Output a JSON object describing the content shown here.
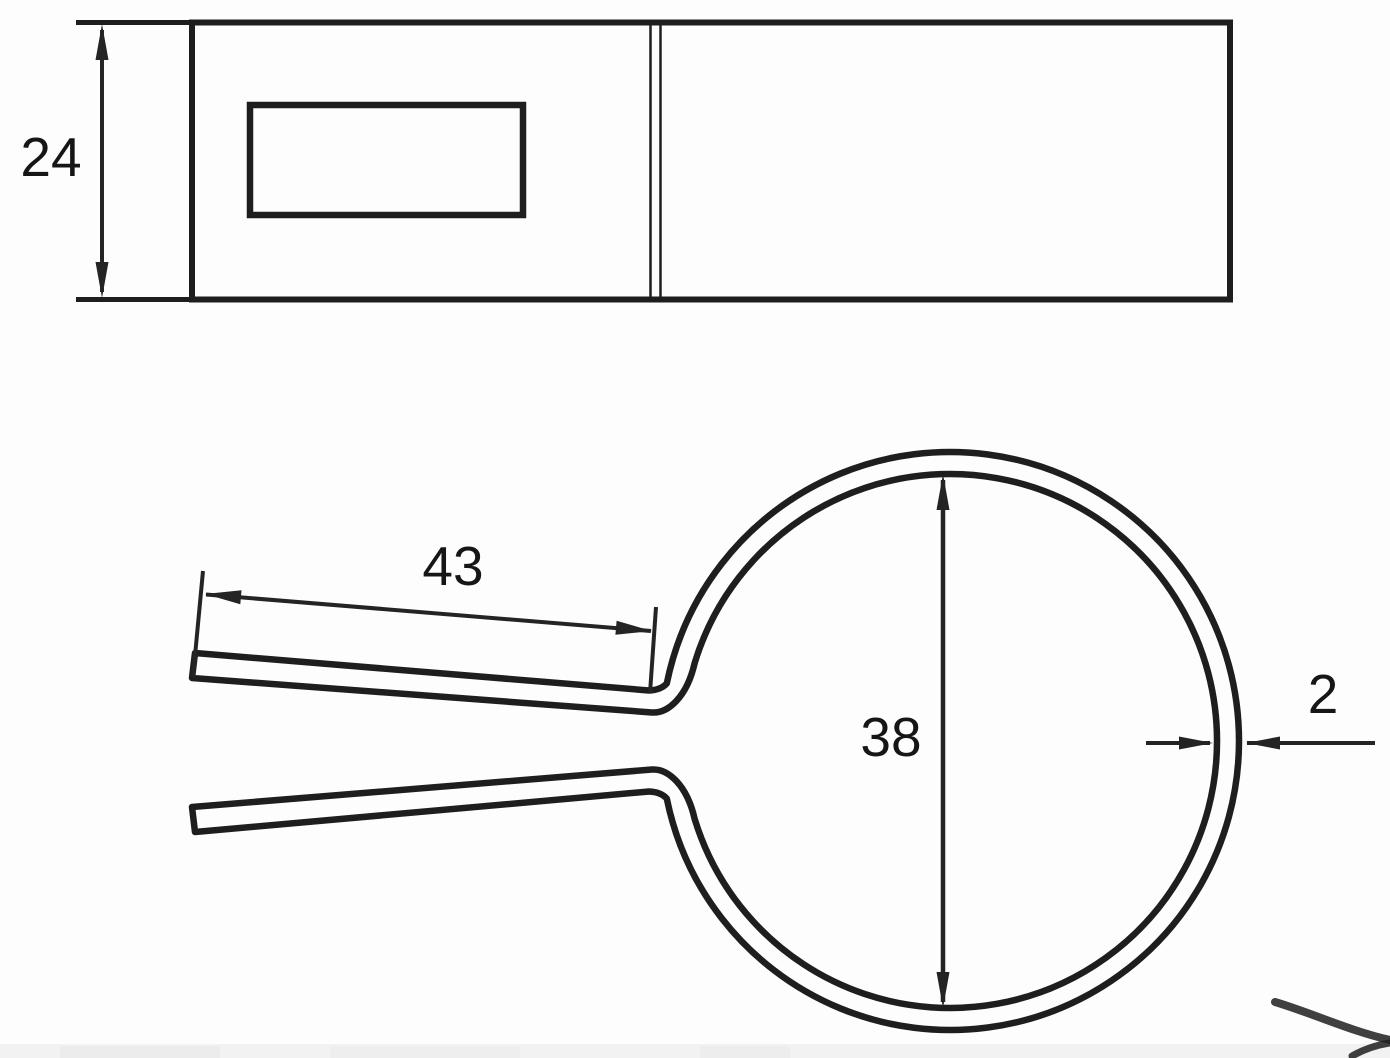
{
  "drawing": {
    "kind": "pipe-clamp-technical-drawing",
    "ink_color": "#1e1e1e",
    "background_color": "#fdfdfd",
    "dimensions": {
      "strip_width": "24",
      "arm_length": "43",
      "inner_diameter": "38",
      "wall_thickness": "2"
    }
  }
}
